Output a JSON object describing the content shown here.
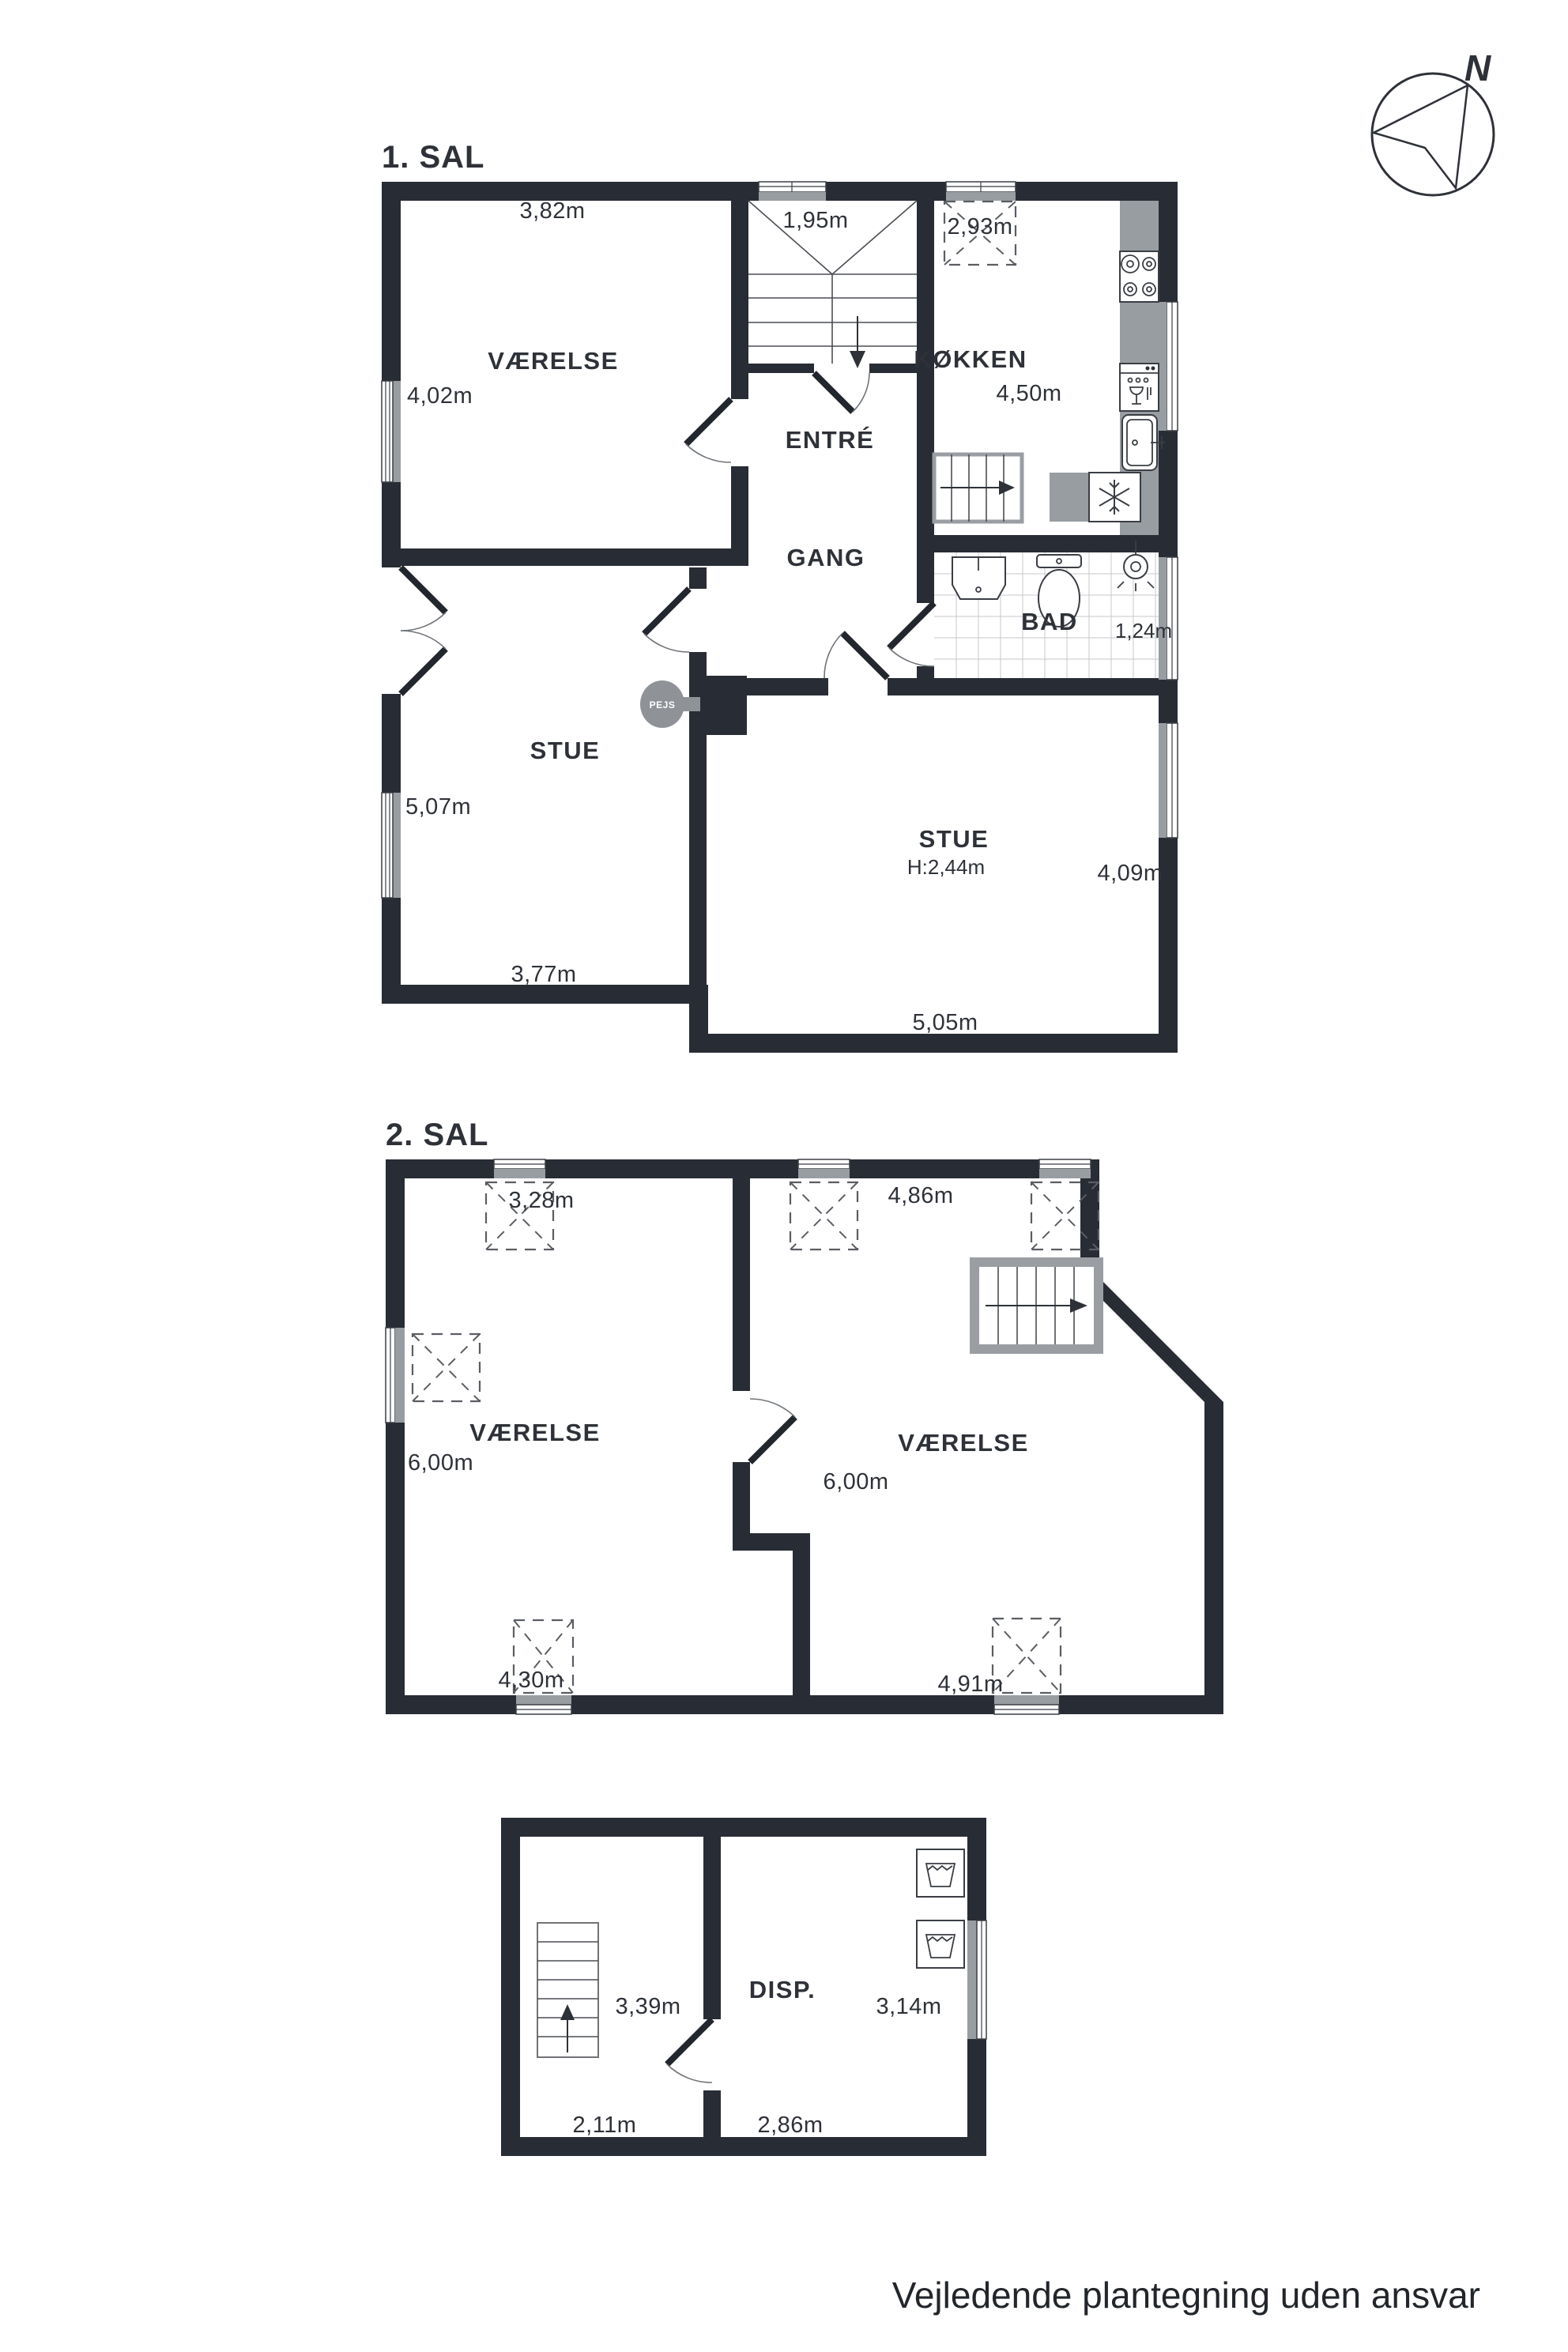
{
  "wall_color": "#282c34",
  "footer": "Vejledende plantegning uden ansvar",
  "compass": {
    "north_label": "N"
  },
  "floor1": {
    "title": "1. SAL",
    "rooms": {
      "vaerelse": "VÆRELSE",
      "entre": "ENTRÉ",
      "koekken": "KØKKEN",
      "gang": "GANG",
      "bad": "BAD",
      "stue_left": "STUE",
      "stue_right": "STUE",
      "pejs": "PEJS"
    },
    "dims": {
      "top_room_w": "3,82m",
      "stair_w": "1,95m",
      "skylight": "2,93m",
      "left_room_h": "4,02m",
      "kitchen_h": "4,50m",
      "bad_w": "1,24m",
      "stue_left_h": "5,07m",
      "stue_left_w": "3,77m",
      "stue_right_w": "5,05m",
      "stue_right_h": "4,09m",
      "ceiling_h": "H:2,44m"
    }
  },
  "floor2": {
    "title": "2. SAL",
    "rooms": {
      "left": "VÆRELSE",
      "right": "VÆRELSE"
    },
    "dims": {
      "skylight_left": "3,28m",
      "skylight_right": "4,86m",
      "left_h": "6,00m",
      "right_h": "6,00m",
      "left_w": "4,30m",
      "right_w": "4,91m"
    }
  },
  "floor3": {
    "rooms": {
      "disp": "DISP."
    },
    "dims": {
      "left_top_w": "3,39m",
      "right_h": "3,14m",
      "left_w": "2,11m",
      "right_w": "2,86m"
    }
  }
}
